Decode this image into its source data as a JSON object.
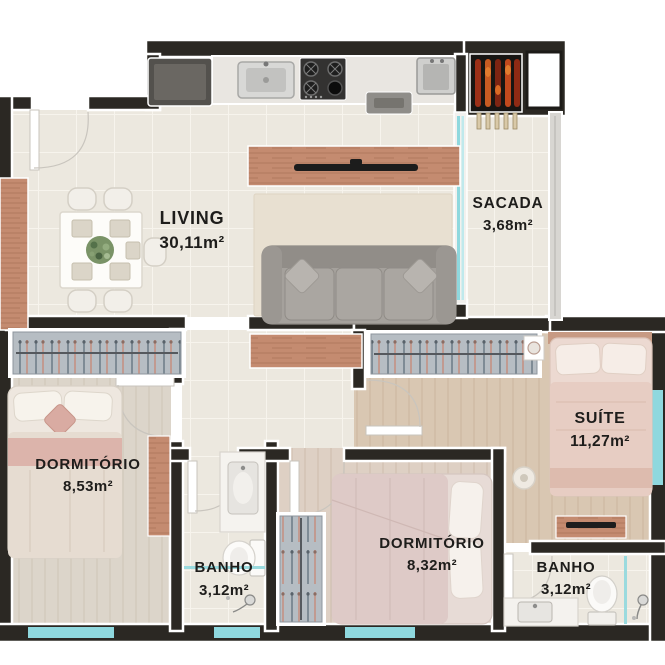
{
  "rooms": [
    {
      "id": "living",
      "name": "LIVING",
      "area": "30,11m²"
    },
    {
      "id": "sacada",
      "name": "SACADA",
      "area": "3,68m²"
    },
    {
      "id": "dormitorio1",
      "name": "DORMITÓRIO",
      "area": "8,53m²"
    },
    {
      "id": "suite",
      "name": "SUÍTE",
      "area": "11,27m²"
    },
    {
      "id": "banho1",
      "name": "BANHO",
      "area": "3,12m²"
    },
    {
      "id": "dormitorio2",
      "name": "DORMITÓRIO",
      "area": "8,32m²"
    },
    {
      "id": "banho2",
      "name": "BANHO",
      "area": "3,12m²"
    }
  ],
  "colors": {
    "wall": "#2b2823",
    "floor_tile": "#ece8df",
    "floor_wood": "#d9c7b2",
    "glass": "#8fd8de",
    "label": "#1e1d1b",
    "furniture_wood": "#c48b70"
  }
}
